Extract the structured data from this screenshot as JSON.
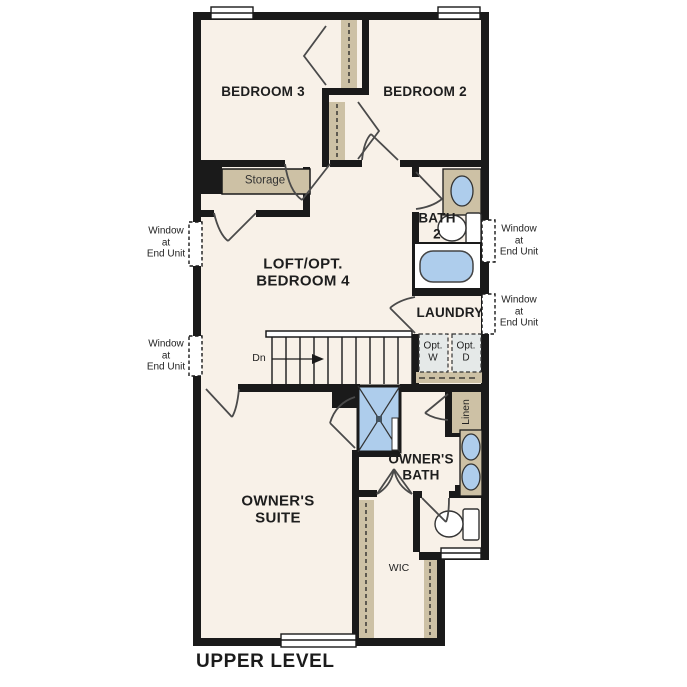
{
  "title": "UPPER LEVEL",
  "rooms": {
    "bedroom3": "BEDROOM 3",
    "bedroom2": "BEDROOM 2",
    "loft": "LOFT/OPT.\nBEDROOM 4",
    "bath2": "BATH\n2",
    "laundry": "LAUNDRY",
    "owners_suite": "OWNER'S\nSUITE",
    "owners_bath": "OWNER'S\nBATH",
    "wic": "WIC",
    "storage": "Storage",
    "linen": "Linen"
  },
  "appliances": {
    "washer": "Opt.\nW",
    "dryer": "Opt.\nD"
  },
  "stairs": {
    "direction_label": "Dn"
  },
  "annotations": {
    "window_left_upper": "Window\nat\nEnd Unit",
    "window_left_lower": "Window\nat\nEnd Unit",
    "window_right_upper": "Window\nat\nEnd Unit",
    "window_right_lower": "Window\nat\nEnd Unit"
  },
  "colors": {
    "wall": "#1a1a1a",
    "floor": "#f8f1e8",
    "closet_tan": "#cdc1a5",
    "fixture_blue": "#aecdec",
    "appliance_gray": "#e5e9e8"
  }
}
